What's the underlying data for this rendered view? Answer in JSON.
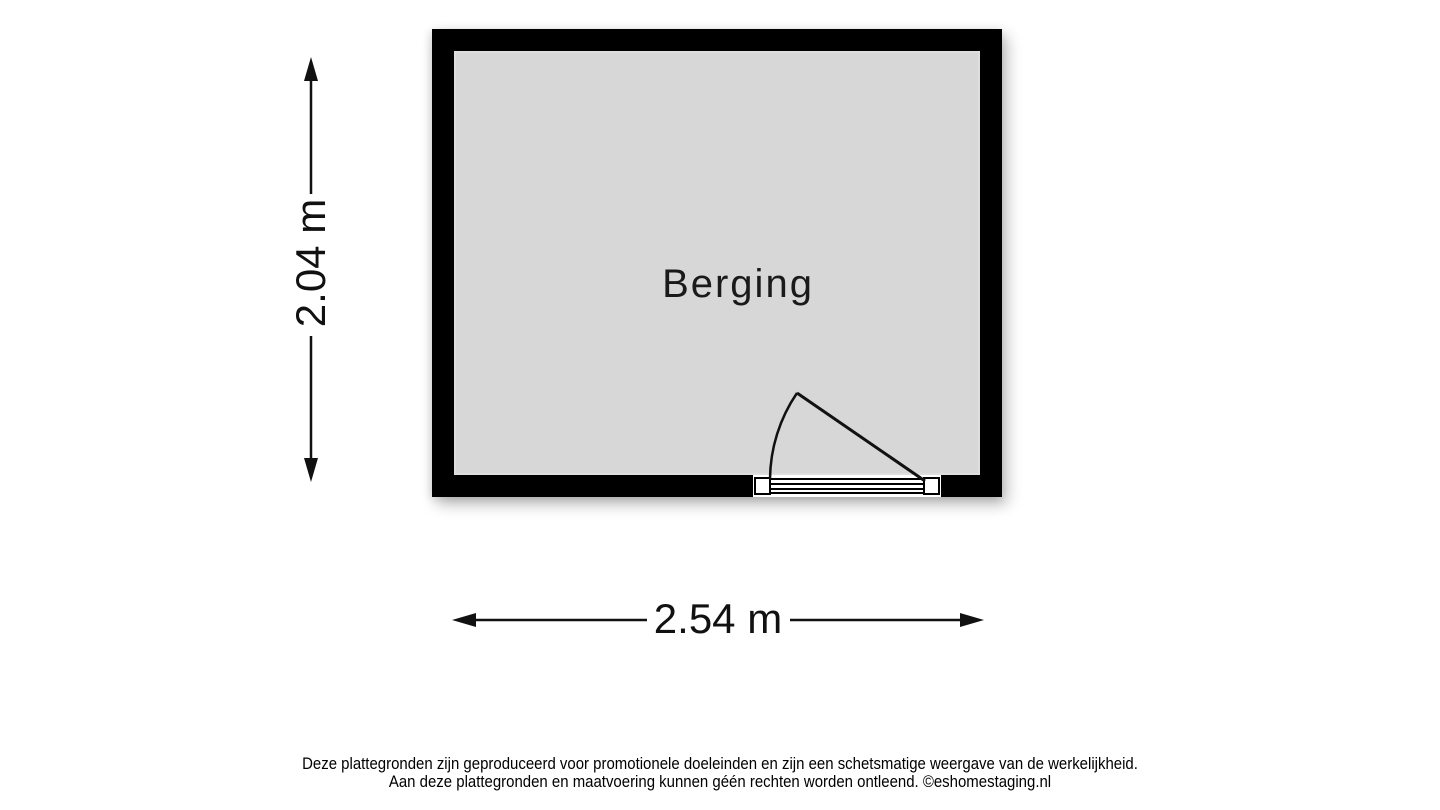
{
  "floorplan": {
    "room": {
      "label": "Berging"
    },
    "dimensions": {
      "width_label": "2.54 m",
      "height_label": "2.04 m"
    },
    "colors": {
      "wall": "#000000",
      "floor": "#d7d7d7",
      "line": "#111111",
      "background": "#ffffff"
    }
  },
  "footer": {
    "line1": "Deze plattegronden zijn geproduceerd voor promotionele doeleinden en zijn een schetsmatige weergave van de werkelijkheid.",
    "line2": "Aan deze plattegronden en maatvoering kunnen géén rechten worden ontleend. ©eshomestaging.nl"
  }
}
